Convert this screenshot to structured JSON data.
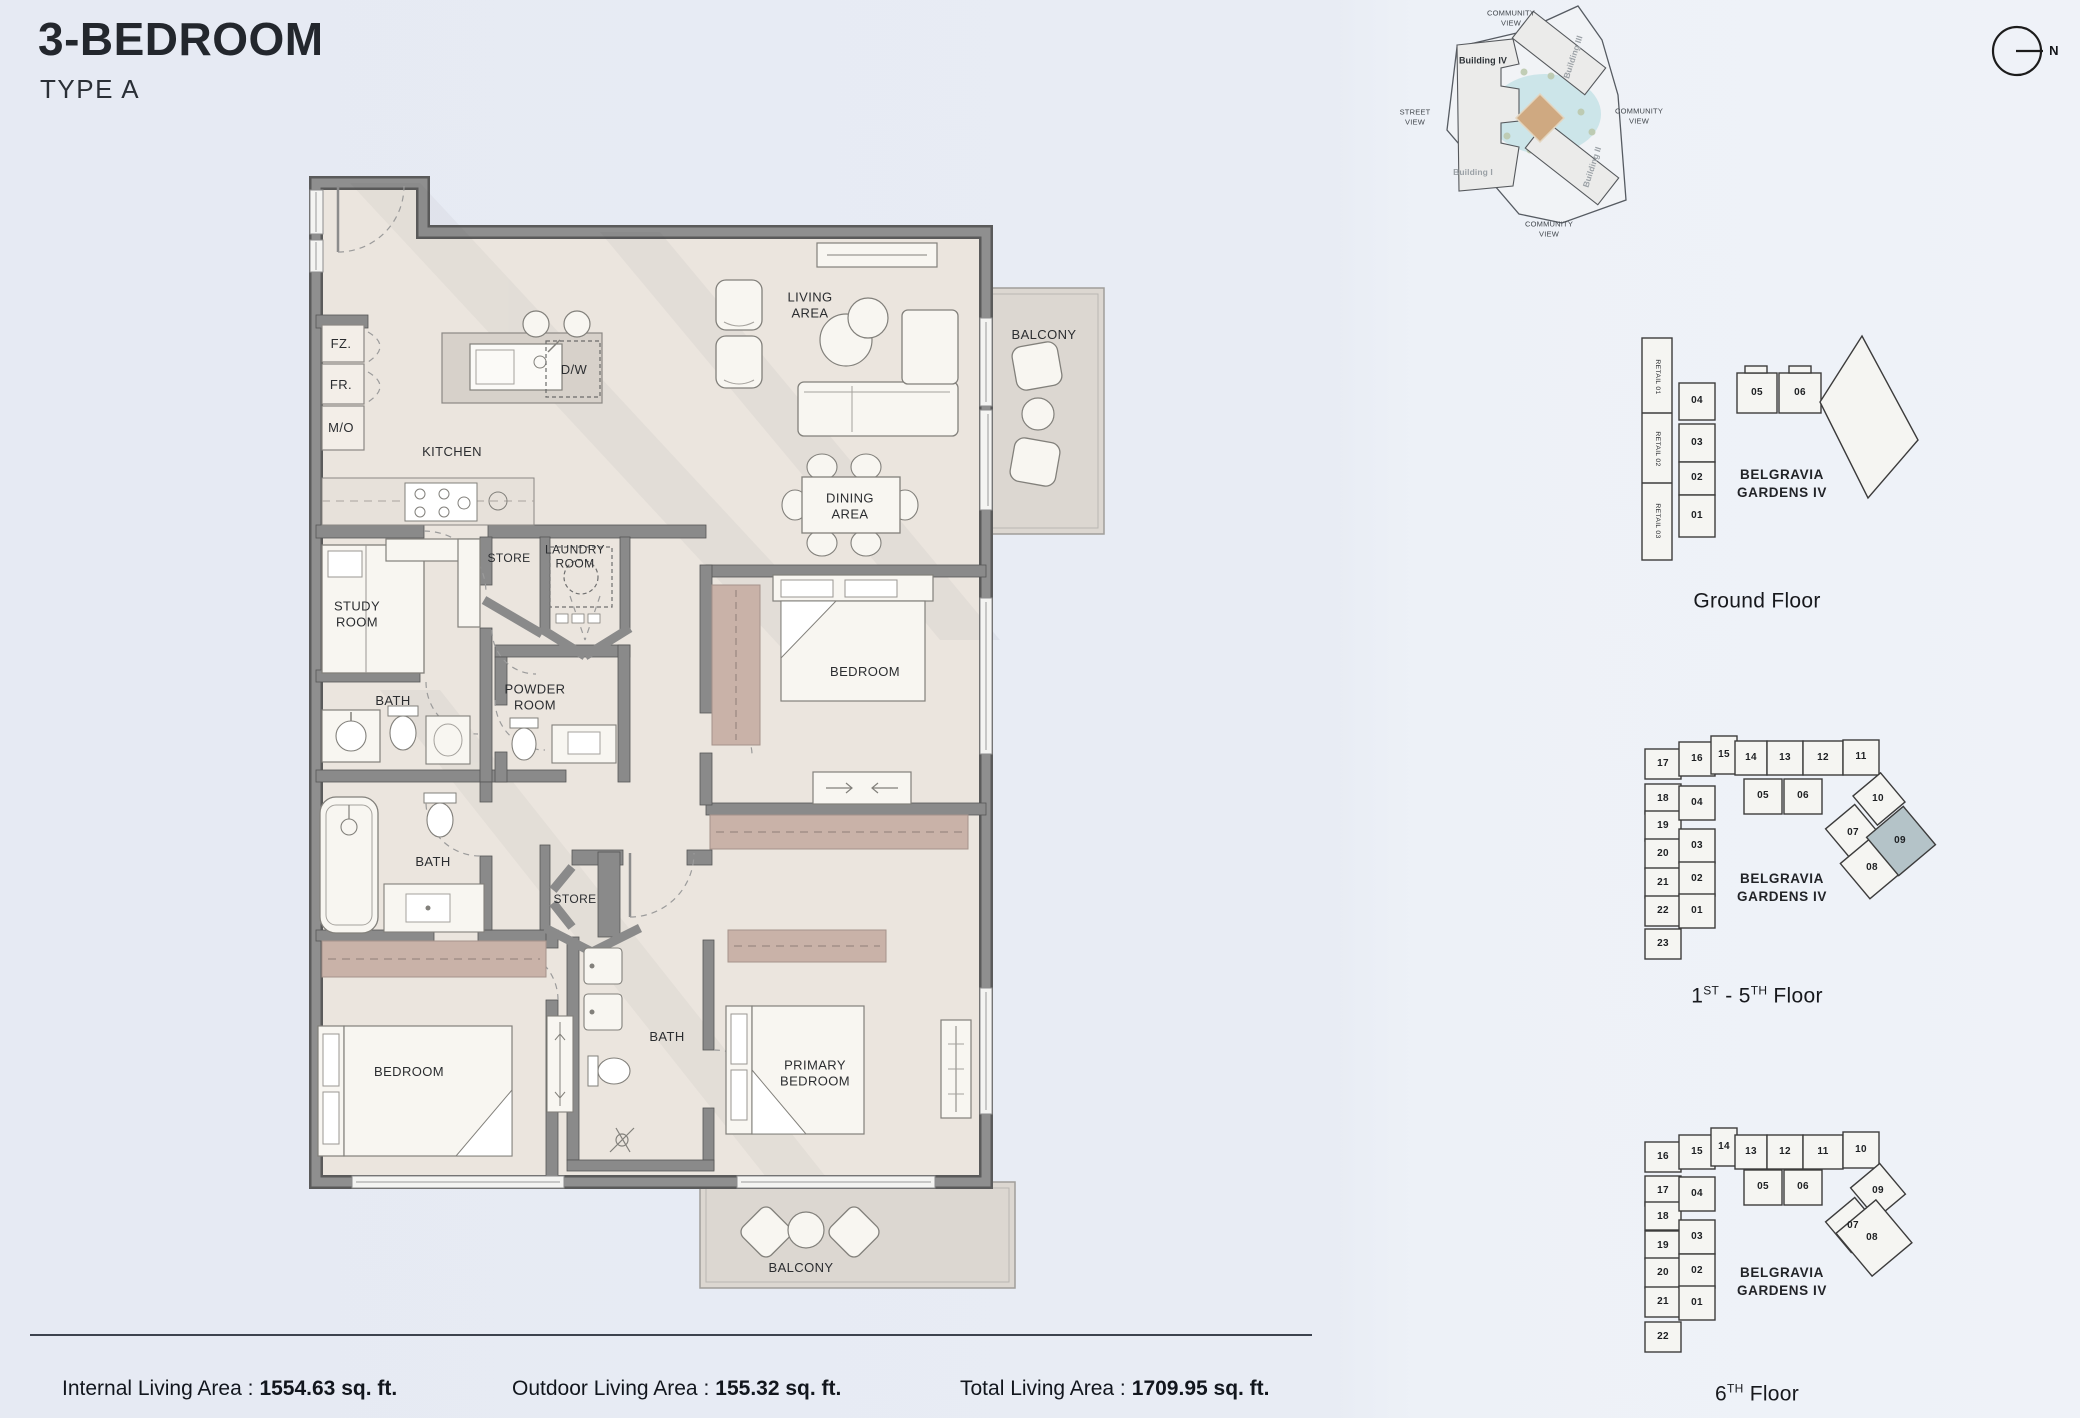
{
  "header": {
    "title": "3-BEDROOM",
    "subtitle": "TYPE A"
  },
  "site_map": {
    "community_view_top": "COMMUNITY\nVIEW",
    "community_view_right": "COMMUNITY\nVIEW",
    "community_view_bottom": "COMMUNITY\nVIEW",
    "street_view": "STREET\nVIEW",
    "building_iv": "Building IV",
    "building_iii": "Building III",
    "building_ii": "Building II",
    "building_i": "Building I",
    "compass_n": "N"
  },
  "floor_plan": {
    "labels": {
      "fz": "FZ.",
      "fr": "FR.",
      "mo": "M/O",
      "kitchen": "KITCHEN",
      "dw": "D/W",
      "store_1": "STORE",
      "laundry": "LAUNDRY\nROOM",
      "study": "STUDY\nROOM",
      "bath_1": "BATH",
      "powder": "POWDER\nROOM",
      "living": "LIVING\nAREA",
      "dining": "DINING\nAREA",
      "balcony_living": "BALCONY",
      "bedroom_mid": "BEDROOM",
      "bath_2": "BATH",
      "store_2": "STORE",
      "bath_3": "BATH",
      "bedroom_left": "BEDROOM",
      "primary_bedroom": "PRIMARY\nBEDROOM",
      "balcony_primary": "BALCONY"
    }
  },
  "key_plans": {
    "building_name": "BELGRAVIA\nGARDENS IV",
    "ground": {
      "title": "Ground Floor",
      "retail": [
        "RETAIL 01",
        "RETAIL 02",
        "RETAIL 03"
      ],
      "units": [
        "04",
        "05",
        "06",
        "03",
        "02",
        "01"
      ]
    },
    "floors_1_5": {
      "title_parts": [
        "1",
        "ST",
        " - 5",
        "TH",
        " Floor"
      ],
      "units": [
        "17",
        "16",
        "15",
        "14",
        "13",
        "12",
        "11",
        "18",
        "04",
        "05",
        "06",
        "10",
        "19",
        "03",
        "07",
        "09",
        "20",
        "02",
        "08",
        "21",
        "22",
        "01",
        "23"
      ],
      "highlighted_unit": "09",
      "highlight_color": "#b4c3c8"
    },
    "floor_6": {
      "title_parts": [
        "6",
        "TH",
        " Floor"
      ],
      "units": [
        "16",
        "15",
        "14",
        "13",
        "12",
        "11",
        "10",
        "17",
        "04",
        "05",
        "06",
        "09",
        "18",
        "03",
        "07",
        "19",
        "08",
        "20",
        "02",
        "21",
        "01",
        "22"
      ]
    }
  },
  "stats": {
    "internal_label": "Internal Living Area :",
    "internal_value": "1554.63 sq. ft.",
    "outdoor_label": "Outdoor Living Area :",
    "outdoor_value": "155.32 sq. ft.",
    "total_label": "Total Living Area :",
    "total_value": "1709.95 sq. ft."
  }
}
